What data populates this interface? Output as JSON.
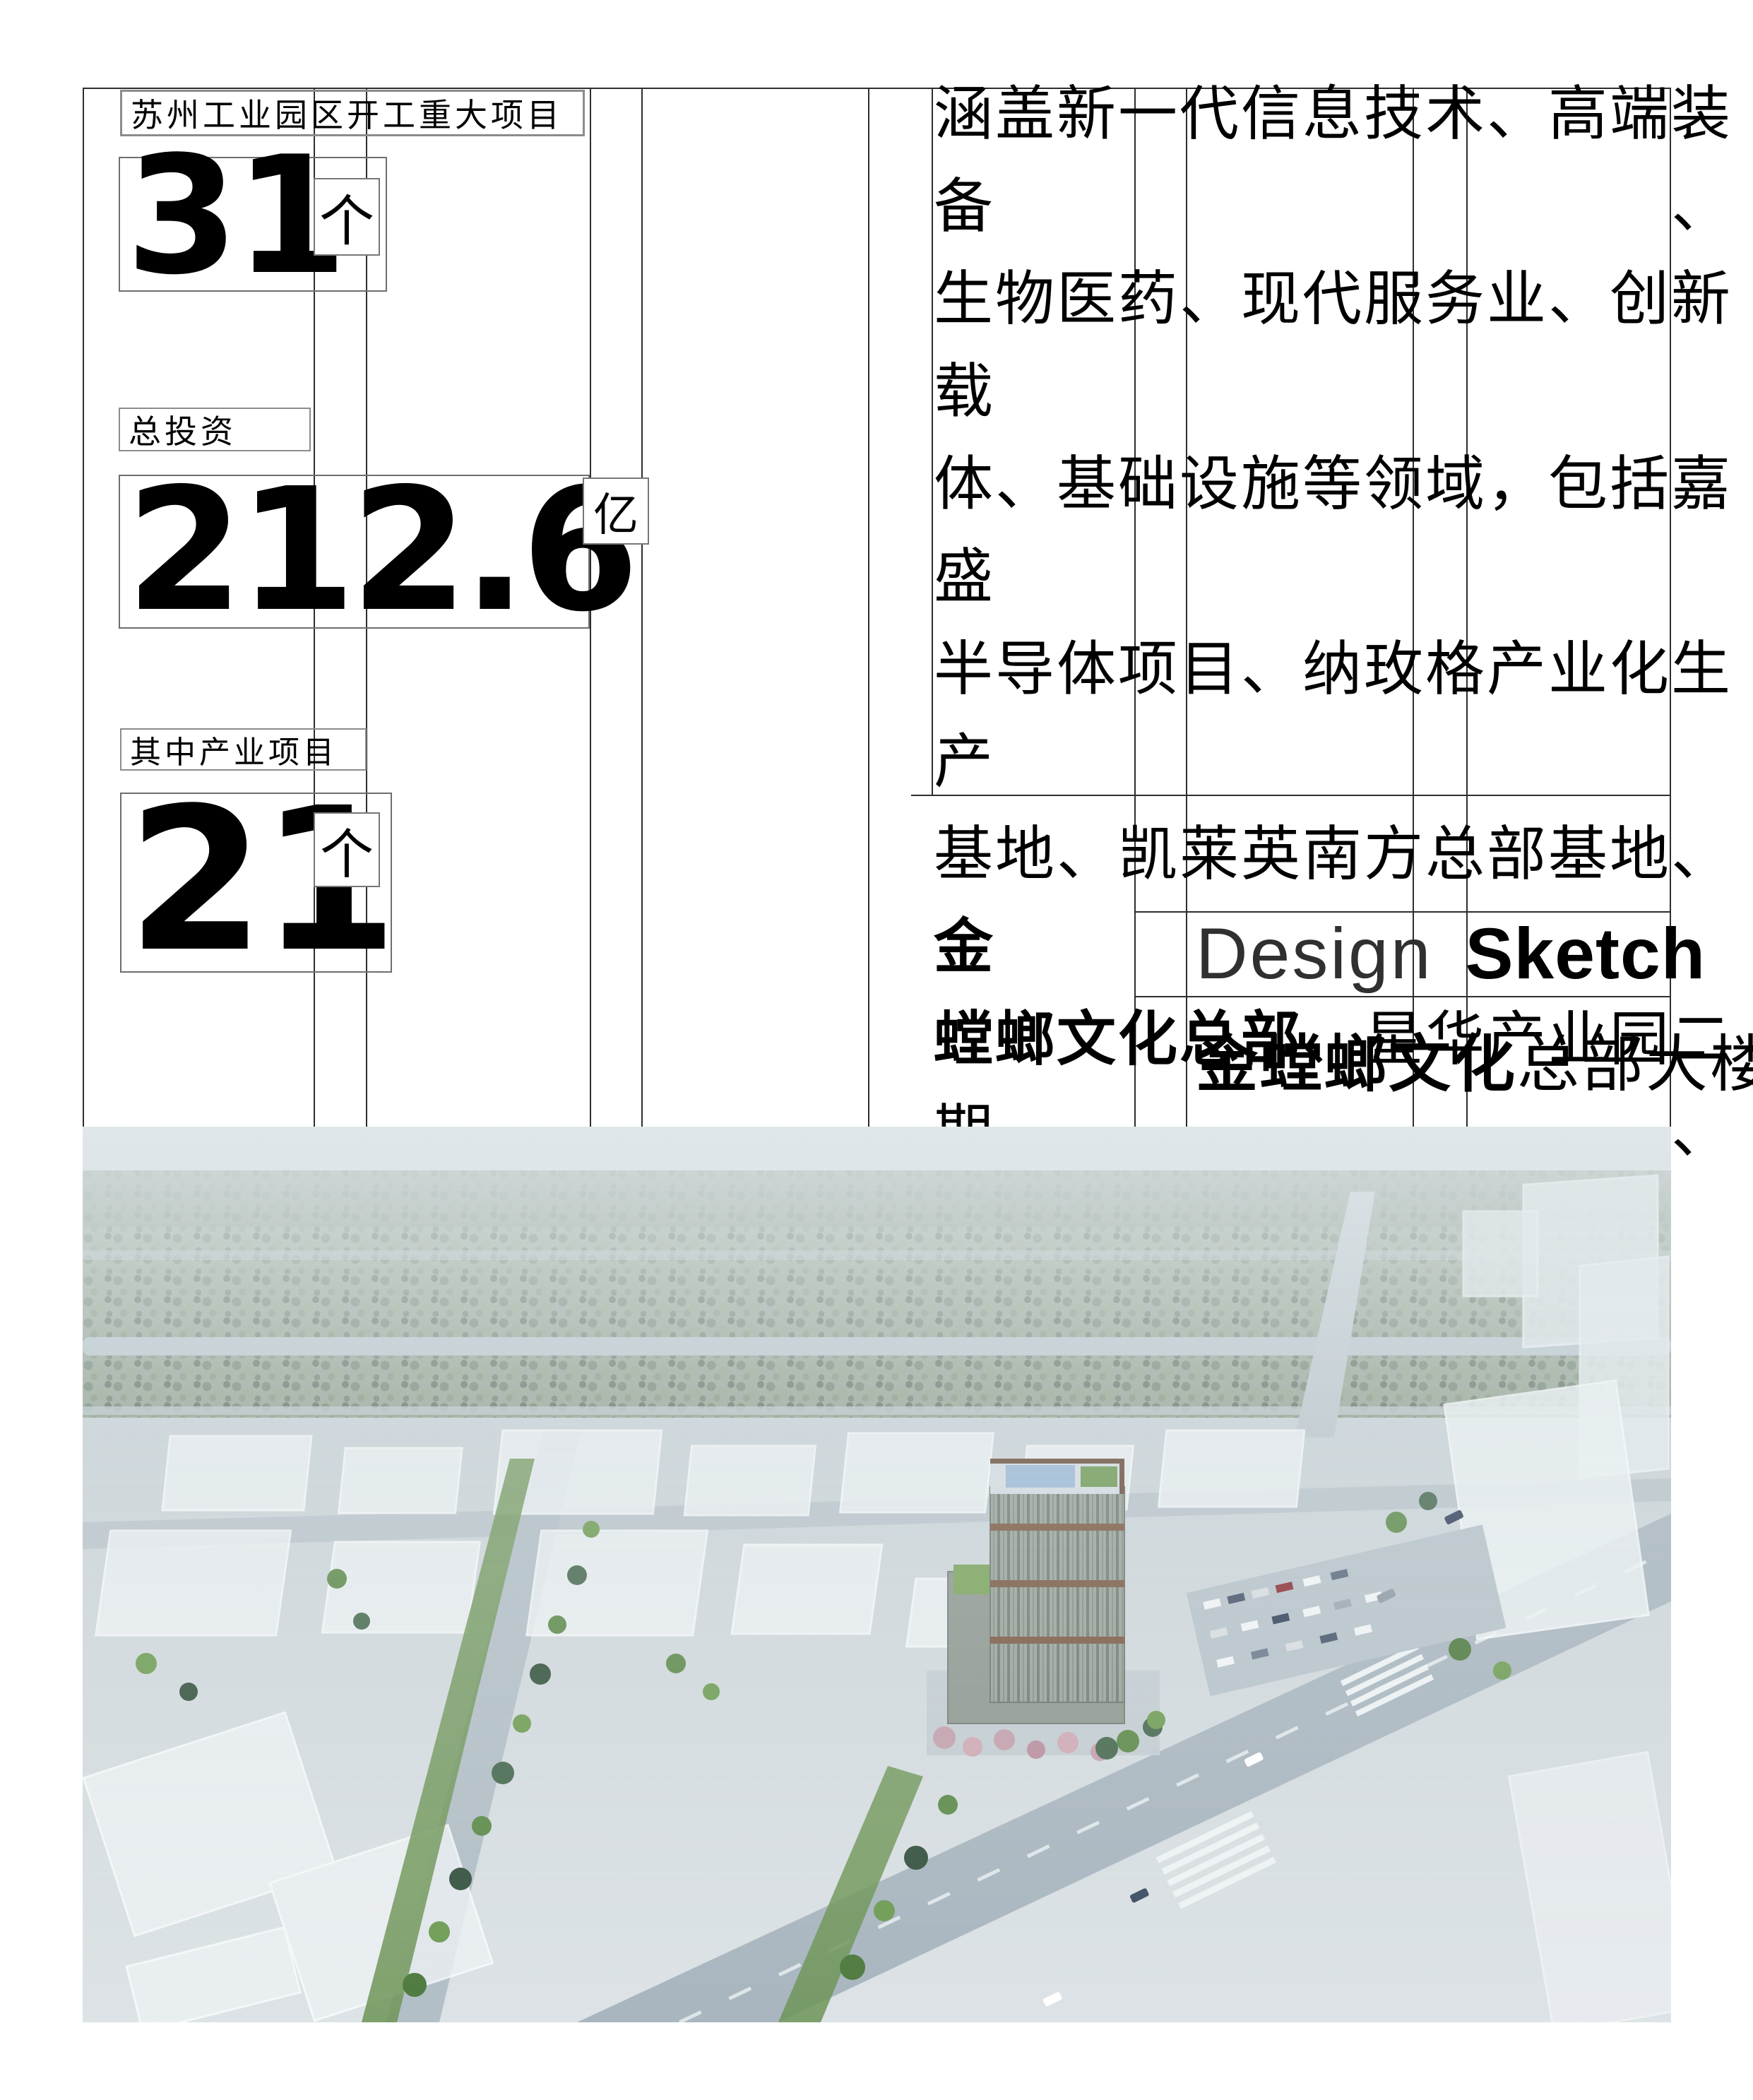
{
  "stats": [
    {
      "label": "苏州工业园区开工重大项目",
      "value": "31",
      "unit": "个"
    },
    {
      "label": "总投资",
      "value": "212.6",
      "unit": "亿"
    },
    {
      "label": "其中产业项目",
      "value": "21",
      "unit": "个"
    }
  ],
  "paragraph": {
    "lines": [
      {
        "justify": true,
        "segments": [
          {
            "text": "涵盖新一代信息技术、高端装备、",
            "bold": false
          }
        ]
      },
      {
        "justify": true,
        "segments": [
          {
            "text": "生物医药、现代服务业、创新载",
            "bold": false
          }
        ]
      },
      {
        "justify": true,
        "segments": [
          {
            "text": "体、基础设施等领域，包括嘉盛",
            "bold": false
          }
        ]
      },
      {
        "justify": true,
        "segments": [
          {
            "text": "半导体项目、纳玫格产业化生产",
            "bold": false
          }
        ]
      },
      {
        "justify": true,
        "segments": [
          {
            "text": "基地、凯莱英南方总部基地、",
            "bold": false
          },
          {
            "text": "金",
            "bold": true
          }
        ]
      },
      {
        "justify": true,
        "segments": [
          {
            "text": "螳螂文化总部",
            "bold": true
          },
          {
            "text": "、星华产业园二期、",
            "bold": false
          }
        ]
      },
      {
        "justify": false,
        "segments": [
          {
            "text": "星汉街北延等。",
            "bold": false
          }
        ]
      }
    ]
  },
  "sketch": {
    "design": "Design",
    "sketch": "Sketch",
    "caption_bold": "金螳螂文化",
    "caption_rest": "总部大楼"
  },
  "colors": {
    "grid_line": "#2e2e2e",
    "box_border": "#6e6e6e",
    "text": "#000000",
    "photo_sky": "#c9d3d8",
    "photo_green": "#6d9457"
  }
}
